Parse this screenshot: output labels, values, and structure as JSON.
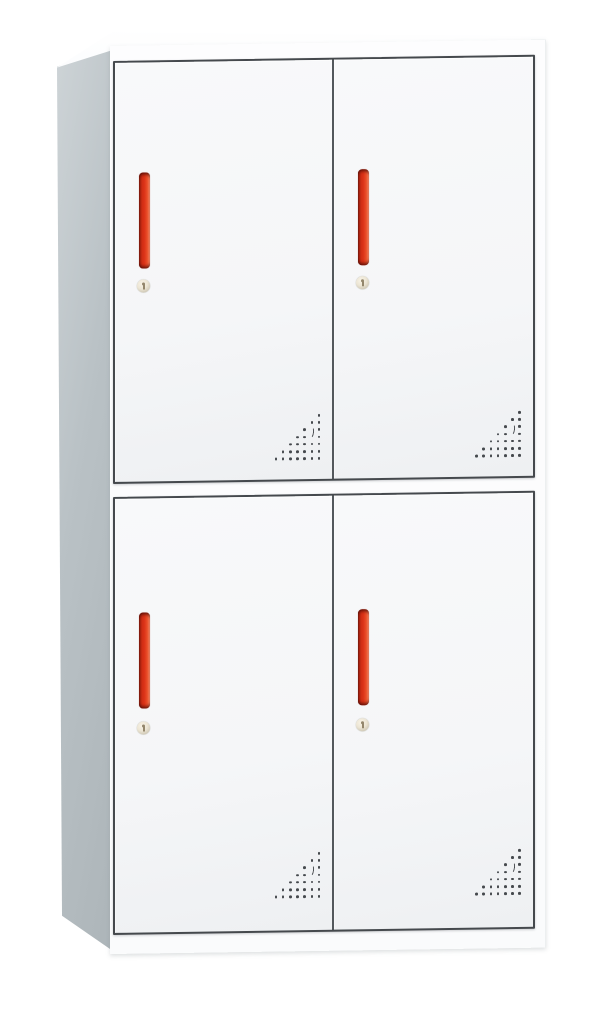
{
  "image": {
    "type": "product-photo",
    "subject": "two-tier four-door steel locker cabinet",
    "background_color": "#ffffff"
  },
  "cabinet": {
    "rows": 2,
    "columns": 2,
    "door_count": 4,
    "colors": {
      "body": "#fafbfc",
      "side_panel": "#b9c1c5",
      "door_face": "#f5f6f8",
      "seam_line": "#45494d",
      "handle_red": "#dd3418",
      "handle_shadow": "#7a1a0c",
      "handle_highlight": "#f58d6b",
      "keyhole_brass": "#ece5d4"
    },
    "doors": [
      {
        "position": "top-left",
        "handle": "red vertical bar",
        "lock": "keyhole",
        "vent": "corner dot triangle"
      },
      {
        "position": "top-right",
        "handle": "red vertical bar",
        "lock": "keyhole",
        "vent": "corner dot triangle"
      },
      {
        "position": "bottom-left",
        "handle": "red vertical bar",
        "lock": "keyhole",
        "vent": "corner dot triangle"
      },
      {
        "position": "bottom-right",
        "handle": "red vertical bar",
        "lock": "keyhole",
        "vent": "corner dot triangle"
      }
    ],
    "vent": {
      "rows": 7,
      "spacing": 7.2,
      "dot_size": 2.6,
      "crescent": {
        "rows": [
          2,
          3
        ],
        "col": 1
      }
    }
  }
}
